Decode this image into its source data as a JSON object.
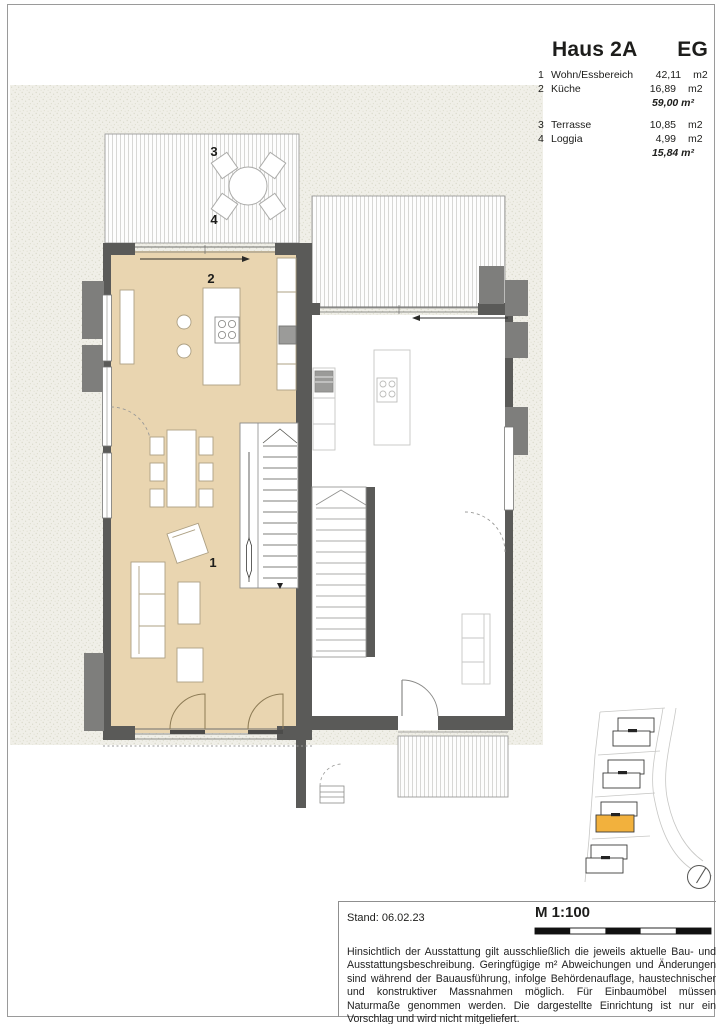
{
  "sheet": {
    "title": "Haus 2A",
    "floor": "EG",
    "legend": {
      "rows": [
        {
          "num": "1",
          "label": "Wohn/Essbereich",
          "value": "42,11",
          "unit": "m2"
        },
        {
          "num": "2",
          "label": "Küche",
          "value": "16,89",
          "unit": "m2"
        },
        {
          "num": "3",
          "label": "Terrasse",
          "value": "10,85",
          "unit": "m2"
        },
        {
          "num": "4",
          "label": "Loggia",
          "value": "4,99",
          "unit": "m2"
        }
      ],
      "subtotal_living": "59,00 m²",
      "subtotal_outdoor": "15,84 m²"
    }
  },
  "plan": {
    "labels": {
      "room1": "1",
      "room2": "2",
      "room3": "3",
      "room4": "4"
    }
  },
  "footer": {
    "stand": "Stand: 06.02.23",
    "scale": "M 1:100",
    "disclaimer": "Hinsichtlich der Ausstattung gilt ausschließlich die jeweils aktuelle Bau- und Ausstattungsbeschreibung. Geringfügige m² Abweichungen und Änderungen sind während der Bauausführung, infolge Behördenauflage, haustechnischer und konstruktiver Massnahmen möglich. Für Einbaumöbel müssen Naturmaße genommen werden. Die dargestellte Einrichtung ist nur ein Vorschlag und wird nicht mitgeliefert."
  },
  "colors": {
    "room_fill": "#E9D5B0",
    "wall": "#5A5A58",
    "accent_orange": "#F2B13D",
    "garden": "#F0EFE8"
  }
}
